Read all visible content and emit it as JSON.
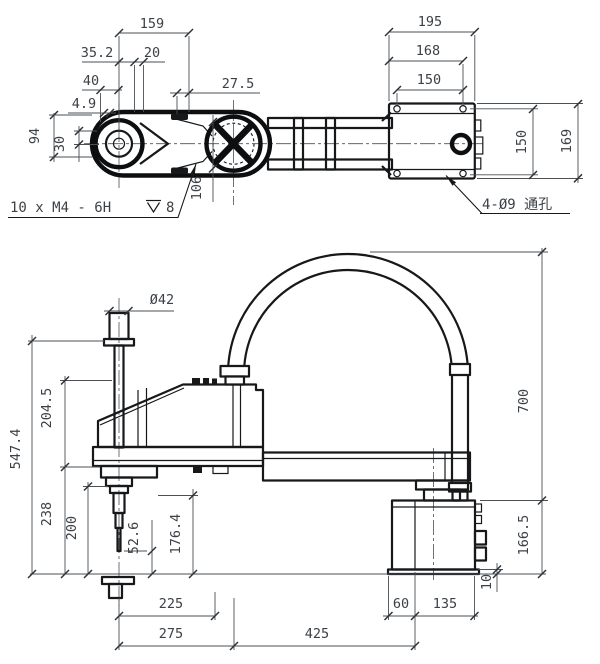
{
  "colors": {
    "line": "#16181a",
    "dim_text": "#3c4147",
    "background": "#ffffff"
  },
  "top_view": {
    "dims": {
      "d159": "159",
      "d35_2": "35.2",
      "d20": "20",
      "d40": "40",
      "d4_9": "4.9",
      "d27_5": "27.5",
      "d94": "94",
      "d30": "30",
      "d106": "106",
      "d195": "195",
      "d168": "168",
      "d150w": "150",
      "d150v": "150",
      "d169": "169"
    },
    "thread_note": {
      "text": "10 x  M4 - 6H",
      "depth": "8"
    },
    "hole_note": "4-Ø9 通孔"
  },
  "side_view": {
    "dims": {
      "dia42": "Ø42",
      "d547_4": "547.4",
      "d204_5": "204.5",
      "d238": "238",
      "d200": "200",
      "d52_6": "52.6",
      "d176_4": "176.4",
      "d166_5": "166.5",
      "d700": "700",
      "d10": "10",
      "d225": "225",
      "d275": "275",
      "d425": "425",
      "d60": "60",
      "d135": "135"
    }
  }
}
